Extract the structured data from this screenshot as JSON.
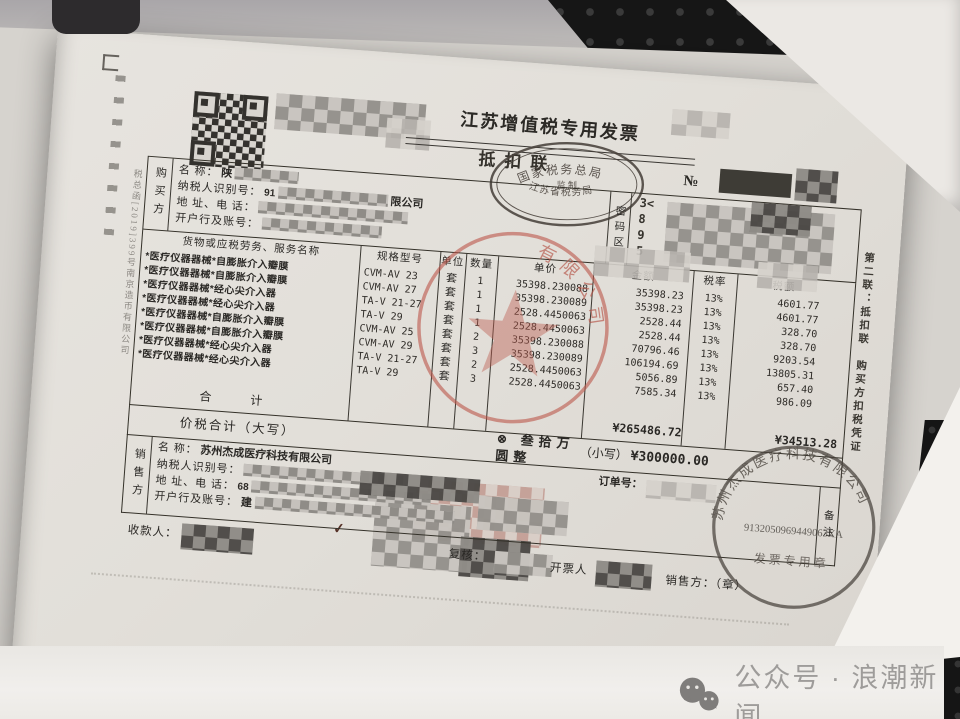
{
  "invoice": {
    "title": "江苏增值税专用发票",
    "serial_prefix": "№",
    "copy_under_title": "抵扣联",
    "supervision_stamp": {
      "top": "国家税务总局",
      "center": "监  制",
      "bottom": "江苏省税务局"
    },
    "buyer": {
      "section_label": "购买方",
      "fields": [
        {
          "label": "名        称：",
          "value": "陕"
        },
        {
          "label": "纳税人识别号：",
          "value": "91"
        },
        {
          "label": "地 址、电 话：",
          "value": ""
        },
        {
          "label": "开户行及账号：",
          "value": ""
        }
      ],
      "name_suffix": "限公司"
    },
    "password_area": {
      "label": "密码区",
      "lines": [
        "3<",
        "8",
        "9",
        "5"
      ]
    },
    "items": {
      "headers": [
        "货物或应税劳务、服务名称",
        "规格型号",
        "单位",
        "数量",
        "单价",
        "金额",
        "税率",
        "税额"
      ],
      "rows": [
        {
          "name": "*医疗仪器器械*自膨胀介入瓣膜",
          "spec": "CVM-AV 23",
          "unit": "套",
          "qty": "1",
          "price": "35398.230088",
          "amount": "35398.23",
          "rate": "13%",
          "tax": "4601.77"
        },
        {
          "name": "*医疗仪器器械*自膨胀介入瓣膜",
          "spec": "CVM-AV 27",
          "unit": "套",
          "qty": "1",
          "price": "35398.230089",
          "amount": "35398.23",
          "rate": "13%",
          "tax": "4601.77"
        },
        {
          "name": "*医疗仪器器械*经心尖介入器",
          "spec": "TA-V 21-27",
          "unit": "套",
          "qty": "1",
          "price": "2528.4450063",
          "amount": "2528.44",
          "rate": "13%",
          "tax": "328.70"
        },
        {
          "name": "*医疗仪器器械*经心尖介入器",
          "spec": "TA-V 29",
          "unit": "套",
          "qty": "1",
          "price": "2528.4450063",
          "amount": "2528.44",
          "rate": "13%",
          "tax": "328.70"
        },
        {
          "name": "*医疗仪器器械*自膨胀介入瓣膜",
          "spec": "CVM-AV 25",
          "unit": "套",
          "qty": "2",
          "price": "35398.230088",
          "amount": "70796.46",
          "rate": "13%",
          "tax": "9203.54"
        },
        {
          "name": "*医疗仪器器械*自膨胀介入瓣膜",
          "spec": "CVM-AV 29",
          "unit": "套",
          "qty": "3",
          "price": "35398.230089",
          "amount": "106194.69",
          "rate": "13%",
          "tax": "13805.31"
        },
        {
          "name": "*医疗仪器器械*经心尖介入器",
          "spec": "TA-V 21-27",
          "unit": "套",
          "qty": "2",
          "price": "2528.4450063",
          "amount": "5056.89",
          "rate": "13%",
          "tax": "657.40"
        },
        {
          "name": "*医疗仪器器械*经心尖介入器",
          "spec": "TA-V 29",
          "unit": "套",
          "qty": "3",
          "price": "2528.4450063",
          "amount": "7585.34",
          "rate": "13%",
          "tax": "986.09"
        }
      ],
      "total_label": "合  计",
      "total_amount": "¥265486.72",
      "total_tax": "¥34513.28"
    },
    "gross": {
      "label": "价税合计（大写）",
      "words": "⊗ 叁拾万圆整",
      "small_label": "（小写）",
      "small_value": "¥300000.00"
    },
    "seller": {
      "section_label": "销售方",
      "fields": [
        {
          "label": "名        称：",
          "value": "苏州杰成医疗科技有限公司"
        },
        {
          "label": "纳税人识别号：",
          "value": ""
        },
        {
          "label": "地 址、电 话：",
          "value": "68"
        },
        {
          "label": "开户行及账号：",
          "value": "建"
        }
      ]
    },
    "remarks": {
      "label": "备注",
      "order_label": "订单号："
    },
    "footer": {
      "payee_label": "收款人：",
      "reviewer_label": "复核：",
      "drawer_label": "开票人",
      "seller_seal_label": "销售方：（章）"
    },
    "middle_stamp": {
      "arc_text": "有限公司"
    },
    "seller_stamp": {
      "company": "苏州杰成医疗科技有限公司",
      "credit_code": "9132050969449063XA",
      "seal_type": "发票专用章"
    },
    "edge_notes": {
      "left_vertical": "税总函[2019]399号南京造币有限公司",
      "right_vertical": "第二联：抵扣联　购买方扣税凭证"
    }
  },
  "photo": {
    "watermark_text": "公众号 · 浪潮新闻"
  }
}
